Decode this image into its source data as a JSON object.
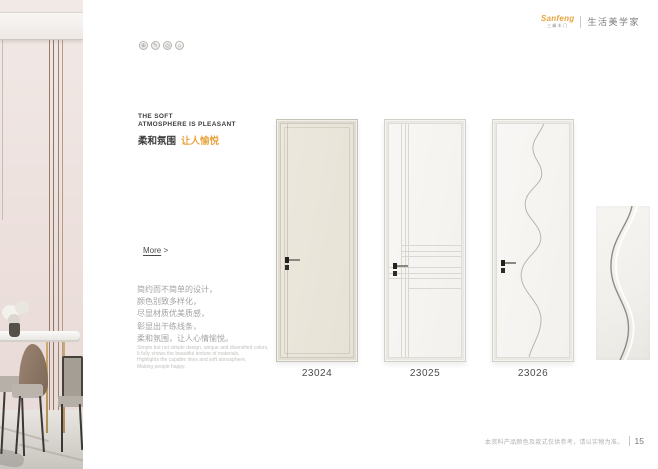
{
  "header": {
    "logo_text": "Sanfeng",
    "logo_subtext": "三峰木门",
    "tagline": "生活美学家",
    "accent_color": "#e8a33d"
  },
  "feature_icons": [
    {
      "name": "quality-badge-icon",
      "glyph": "⊕"
    },
    {
      "name": "design-badge-icon",
      "glyph": "✎"
    },
    {
      "name": "material-badge-icon",
      "glyph": "◎"
    },
    {
      "name": "eco-badge-icon",
      "glyph": "⌂"
    }
  ],
  "intro": {
    "heading_line1": "THE SOFT",
    "heading_line2": "ATMOSPHERE IS PLEASANT",
    "subheading_primary": "柔和氛围",
    "subheading_accent": "让人愉悦",
    "more_label": "More",
    "more_arrow": " >",
    "paragraph_zh": [
      "简约而不简单的设计，",
      "颜色别致多样化，",
      "尽显材质优美质感，",
      "彰显出干练线条，",
      "柔和氛围，让人心情愉悦。"
    ],
    "paragraph_en": [
      "Simple but not simple design, unique and diversified colors,",
      "It fully shows the beautiful texture of materials,",
      "Highlights the capable lines and soft atmosphere,",
      "Making people happy."
    ]
  },
  "products": [
    {
      "model": "23024",
      "design": "plain cream slab"
    },
    {
      "model": "23025",
      "design": "crossing line grooves"
    },
    {
      "model": "23026",
      "design": "wave groove"
    }
  ],
  "footer": {
    "disclaimer": "本资料产品颜色及款式仅供参考，请以实物为准。",
    "page_number": "15"
  },
  "colors": {
    "accent": "#e8a33d",
    "door_cream": "#e9e5da",
    "door_white": "#f6f5f2",
    "text_dark": "#3d3d3d",
    "text_gray": "#a3a3a3"
  }
}
